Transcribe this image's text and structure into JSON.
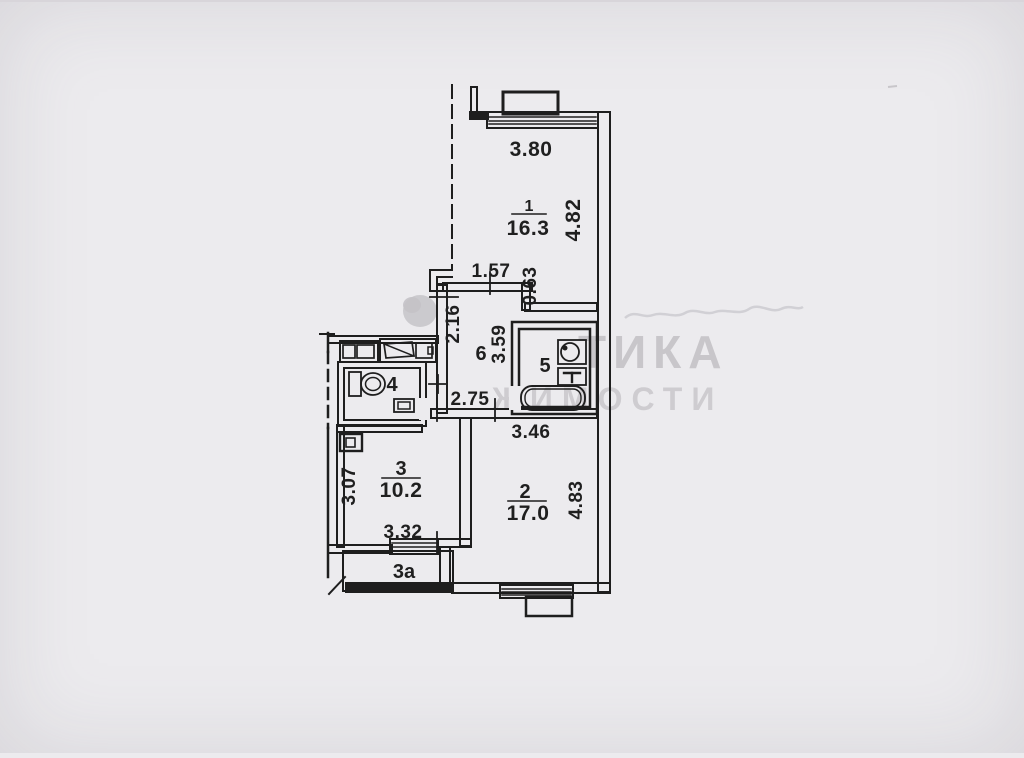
{
  "watermark": {
    "line1": "ТИКА",
    "line2": "ЖИМОСТИ"
  },
  "rooms": {
    "r1": {
      "number": "1",
      "area": "16.3"
    },
    "r2": {
      "number": "2",
      "area": "17.0"
    },
    "r3": {
      "number": "3",
      "area": "10.2"
    },
    "r3a": {
      "number": "3а"
    },
    "r4": {
      "number": "4"
    },
    "r5": {
      "number": "5"
    },
    "r6": {
      "number": "6"
    }
  },
  "dimensions": {
    "top_width": "3.80",
    "room1_depth": "4.82",
    "hall_top": "1.57",
    "offset": "0.63",
    "hall_left": "2.16",
    "hall_right": "3.59",
    "hall_bottom": "2.75",
    "room2_top": "3.46",
    "room3_left": "3.07",
    "room3_bottom": "3.32",
    "room2_right": "4.83"
  },
  "colors": {
    "background": "#ECEBEE",
    "ink": "#1F1F1F",
    "watermark": "#BCBABE"
  }
}
